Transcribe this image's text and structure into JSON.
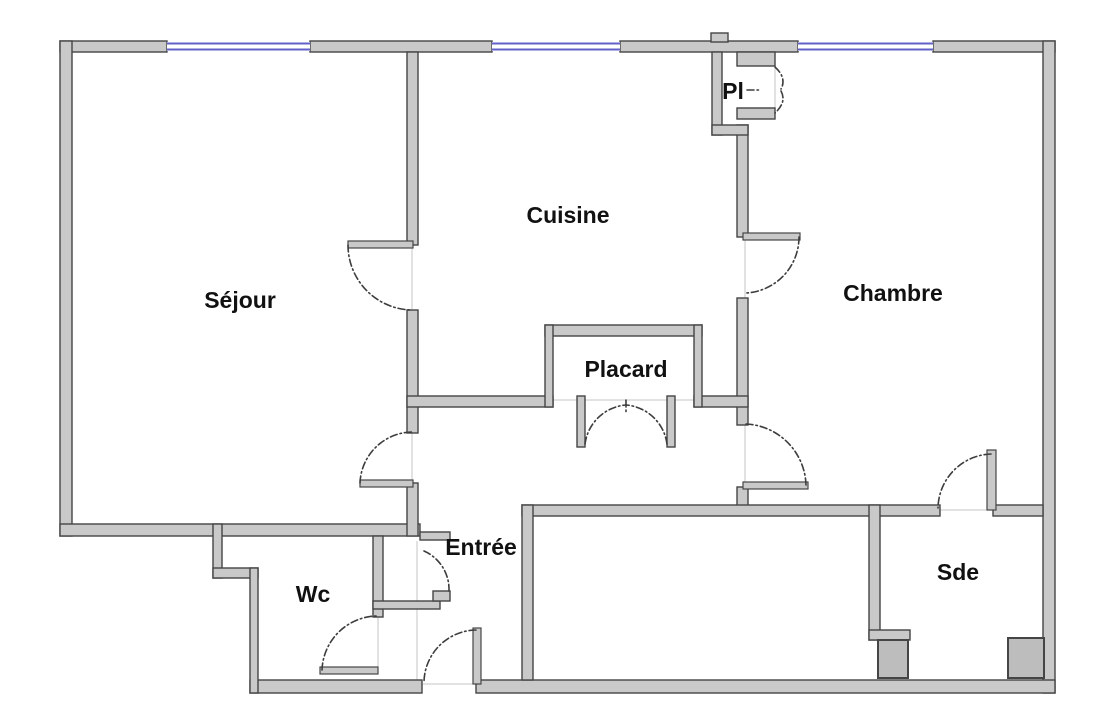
{
  "plan": {
    "type": "apartment-floor-plan",
    "rooms": [
      {
        "id": "sejour",
        "label": "Séjour"
      },
      {
        "id": "cuisine",
        "label": "Cuisine"
      },
      {
        "id": "chambre",
        "label": "Chambre"
      },
      {
        "id": "pl",
        "label": "Pl"
      },
      {
        "id": "placard",
        "label": "Placard"
      },
      {
        "id": "entree",
        "label": "Entrée"
      },
      {
        "id": "wc",
        "label": "Wc"
      },
      {
        "id": "sde",
        "label": "Sde"
      }
    ],
    "window_count": 3,
    "colors": {
      "background": "#ffffff",
      "wall_fill": "#c9c9c9",
      "wall_stroke": "#454545",
      "window": "#6060c8",
      "door_arc": "#3d3d3d",
      "fixture_fill": "#bdbdbd",
      "label": "#111111"
    }
  }
}
